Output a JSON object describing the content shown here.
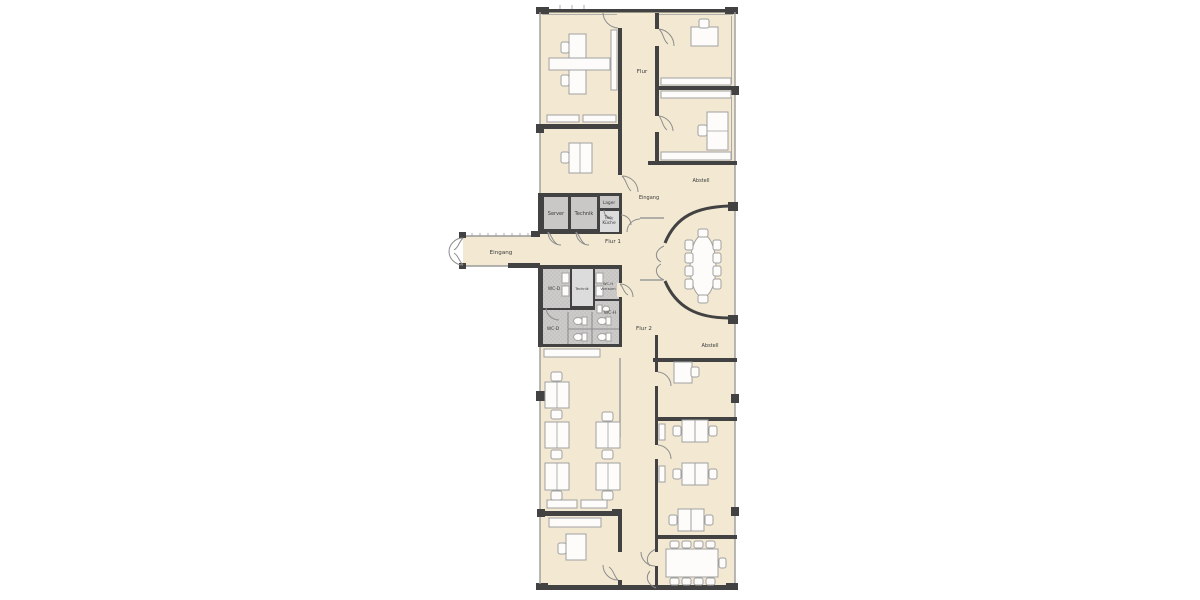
{
  "colors": {
    "background": "#ffffff",
    "floor": "#f3e9d3",
    "wall": "#424242",
    "glass": "#9a9a9a",
    "room_gray": "#c9c8c6",
    "room_light": "#dcdcdc",
    "wc_tile": "#cccbc9",
    "wc_dot": "#b0afad",
    "furniture_fill": "#fdfcfa",
    "furniture_stroke": "#a0a0a0",
    "door": "#8c8c8c",
    "text": "#3a3a3a"
  },
  "labels": {
    "flur": "Flur",
    "flur1": "Flur 1",
    "flur2": "Flur 2",
    "eingang_left": "Eingang",
    "eingang_right": "Eingang",
    "abstell_top": "Abstell",
    "abstell_bottom": "Abstell",
    "server": "Server",
    "technik": "Technik",
    "lager": "Lager",
    "teekueche_line1": "Tee-",
    "teekueche_line2": "Küche",
    "wc_d_top": "WC-D",
    "technik_small": "Technik",
    "wc_h_vorraum_line1": "WC-H",
    "wc_h_vorraum_line2": "Vorraum",
    "wc_h": "WC-H",
    "wc_d_bottom": "WC-D"
  }
}
